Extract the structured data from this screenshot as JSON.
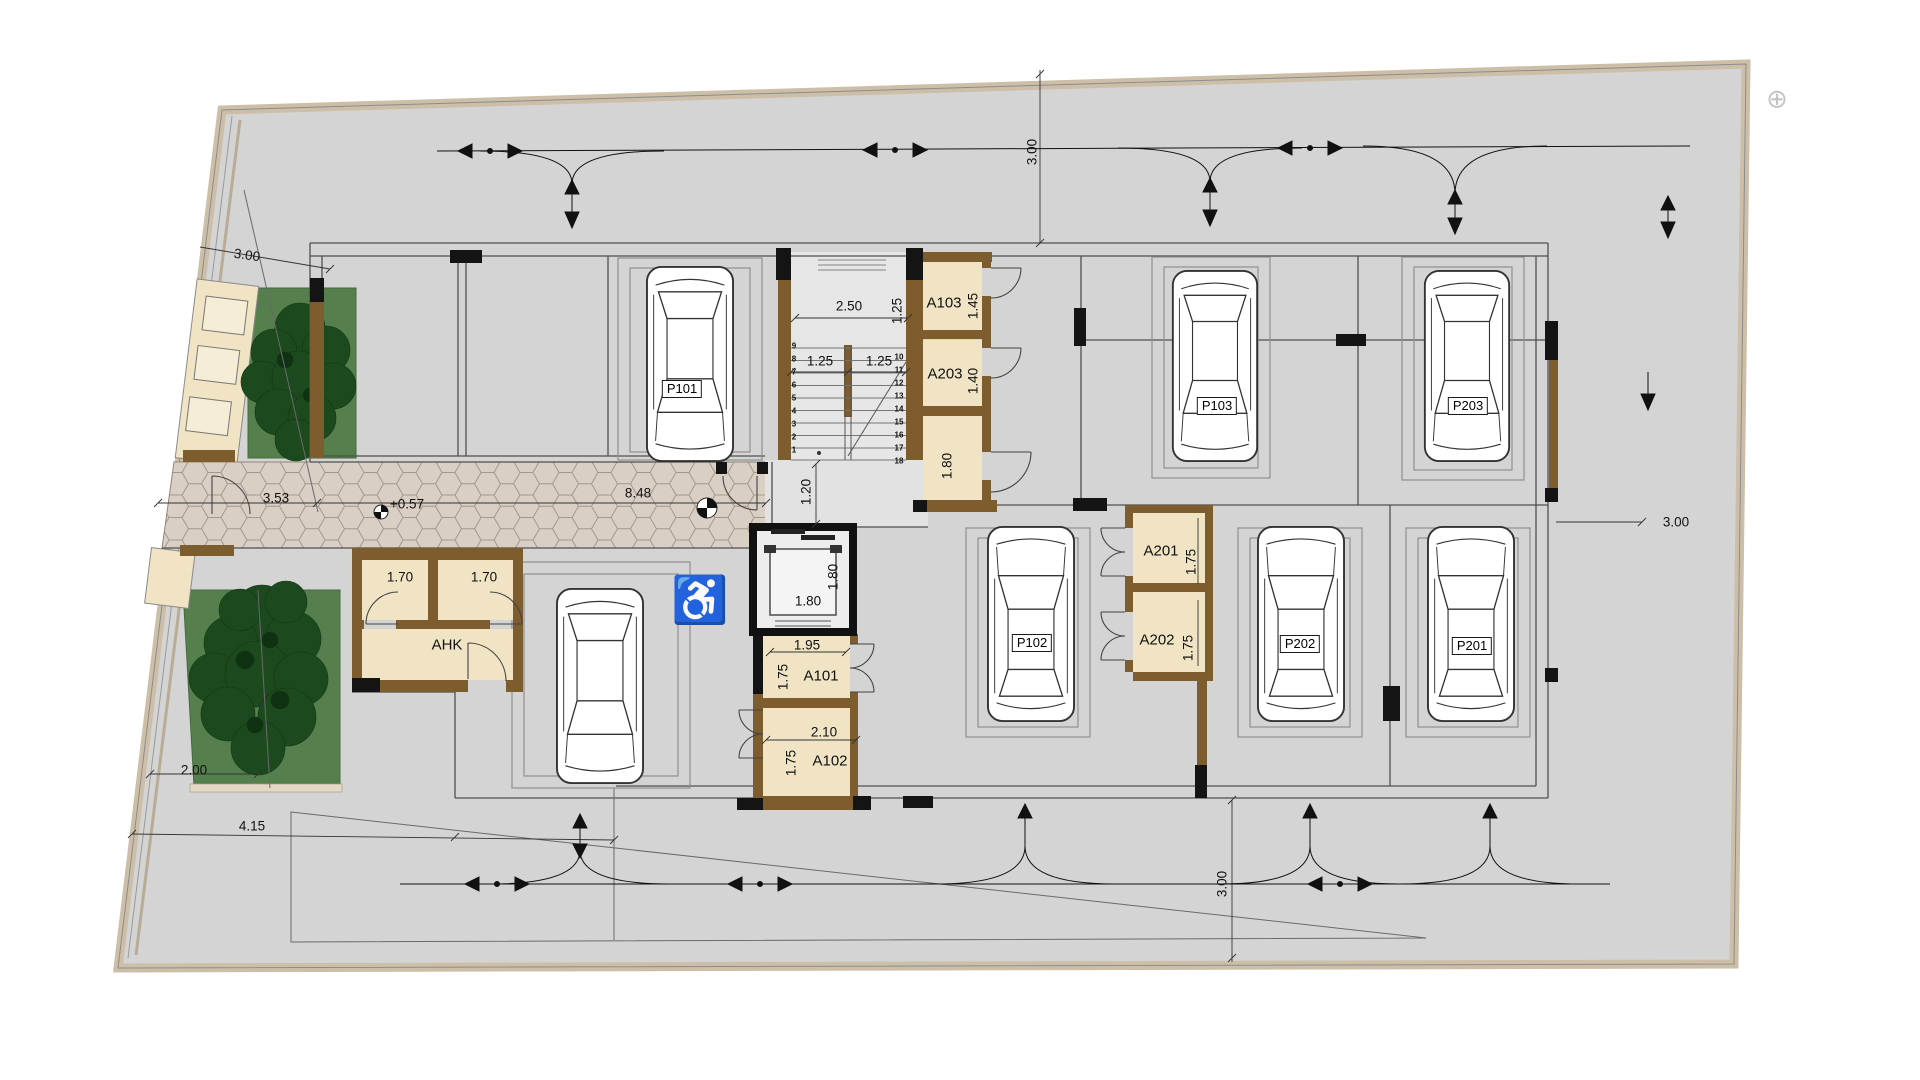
{
  "colors": {
    "site": "#d4d4d4",
    "room_fill": "#f0e4c4",
    "wall_brown": "#7d5c2e",
    "wall_black": "#141414",
    "grass": "#55804d",
    "tree": "#1c4a1e",
    "paving": "#d9cfc5",
    "boundary": "#cdbfa7"
  },
  "parking": {
    "p101": "P101",
    "p102": "P102",
    "p103": "P103",
    "p201": "P201",
    "p202": "P202",
    "p203": "P203"
  },
  "rooms": {
    "a101": "A101",
    "a102": "A102",
    "a103": "A103",
    "a201": "A201",
    "a202": "A202",
    "a203": "A203",
    "ahk": "AHK"
  },
  "dims": {
    "site_left": "3.00",
    "site_top": "3.00",
    "site_right": "3.00",
    "site_bottom": "3.00",
    "stair_width": "2.50",
    "stair_landing": "1.25",
    "flight_left": "1.25",
    "flight_right": "1.25",
    "a103_depth": "1.45",
    "a203_depth": "1.40",
    "store_depth": "1.80",
    "corridor_width": "1.20",
    "elevator_depth": "1.80",
    "elevator_width": "1.80",
    "a101_width": "1.95",
    "a101_depth": "1.75",
    "a102_width": "2.10",
    "a102_depth": "1.75",
    "a201_depth": "1.75",
    "a202_depth": "1.75",
    "ahk_left": "1.70",
    "ahk_right": "1.70",
    "path_segment_left": "3.53",
    "entry_level": "+0.57",
    "path_segment_right": "8.48",
    "garden_width": "2.00",
    "ramp_width": "4.15"
  },
  "stairs": {
    "left_steps": [
      "9",
      "8",
      "7",
      "6",
      "5",
      "4",
      "3",
      "2",
      "1"
    ],
    "right_steps": [
      "10",
      "11",
      "12",
      "13",
      "14",
      "15",
      "16",
      "17",
      "18"
    ]
  },
  "icons": {
    "wheelchair": "♿",
    "survey_mark": "⊕"
  }
}
